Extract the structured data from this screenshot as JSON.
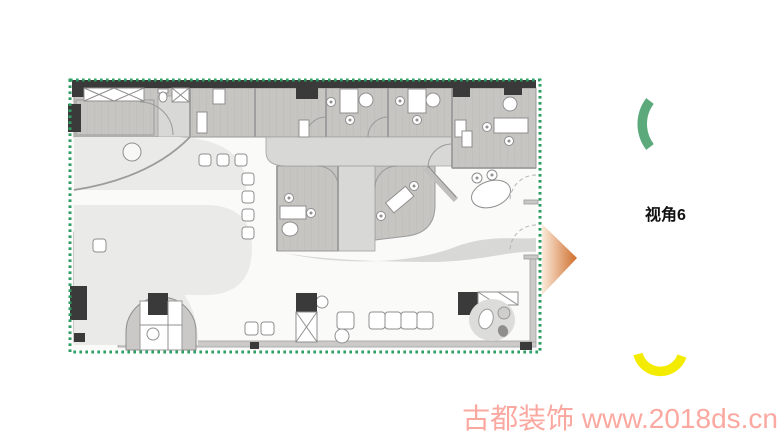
{
  "plan": {
    "name": "office-floor-plan",
    "border_color": "#2f9e63",
    "wall_color": "#3a3a3a",
    "wood_color": "#c7c5c2",
    "wood_grain_color": "#bcb9b5",
    "corridor_color": "#d8d8d6",
    "carpet_color": "#eaeae8",
    "lobby_color": "#fafaf9",
    "line_color": "#8f8f8f"
  },
  "viewpoint": {
    "label": "视角6",
    "label_color": "#111111",
    "arrow_base_color": "#fbeada",
    "arrow_tip_color": "#cf6e2c",
    "green_arc_color": "#5caa7c",
    "yellow_arc_color": "#f4ec00"
  },
  "watermark": {
    "text": "古都装饰 www.2018ds.cn",
    "color": "#fba8a1"
  }
}
